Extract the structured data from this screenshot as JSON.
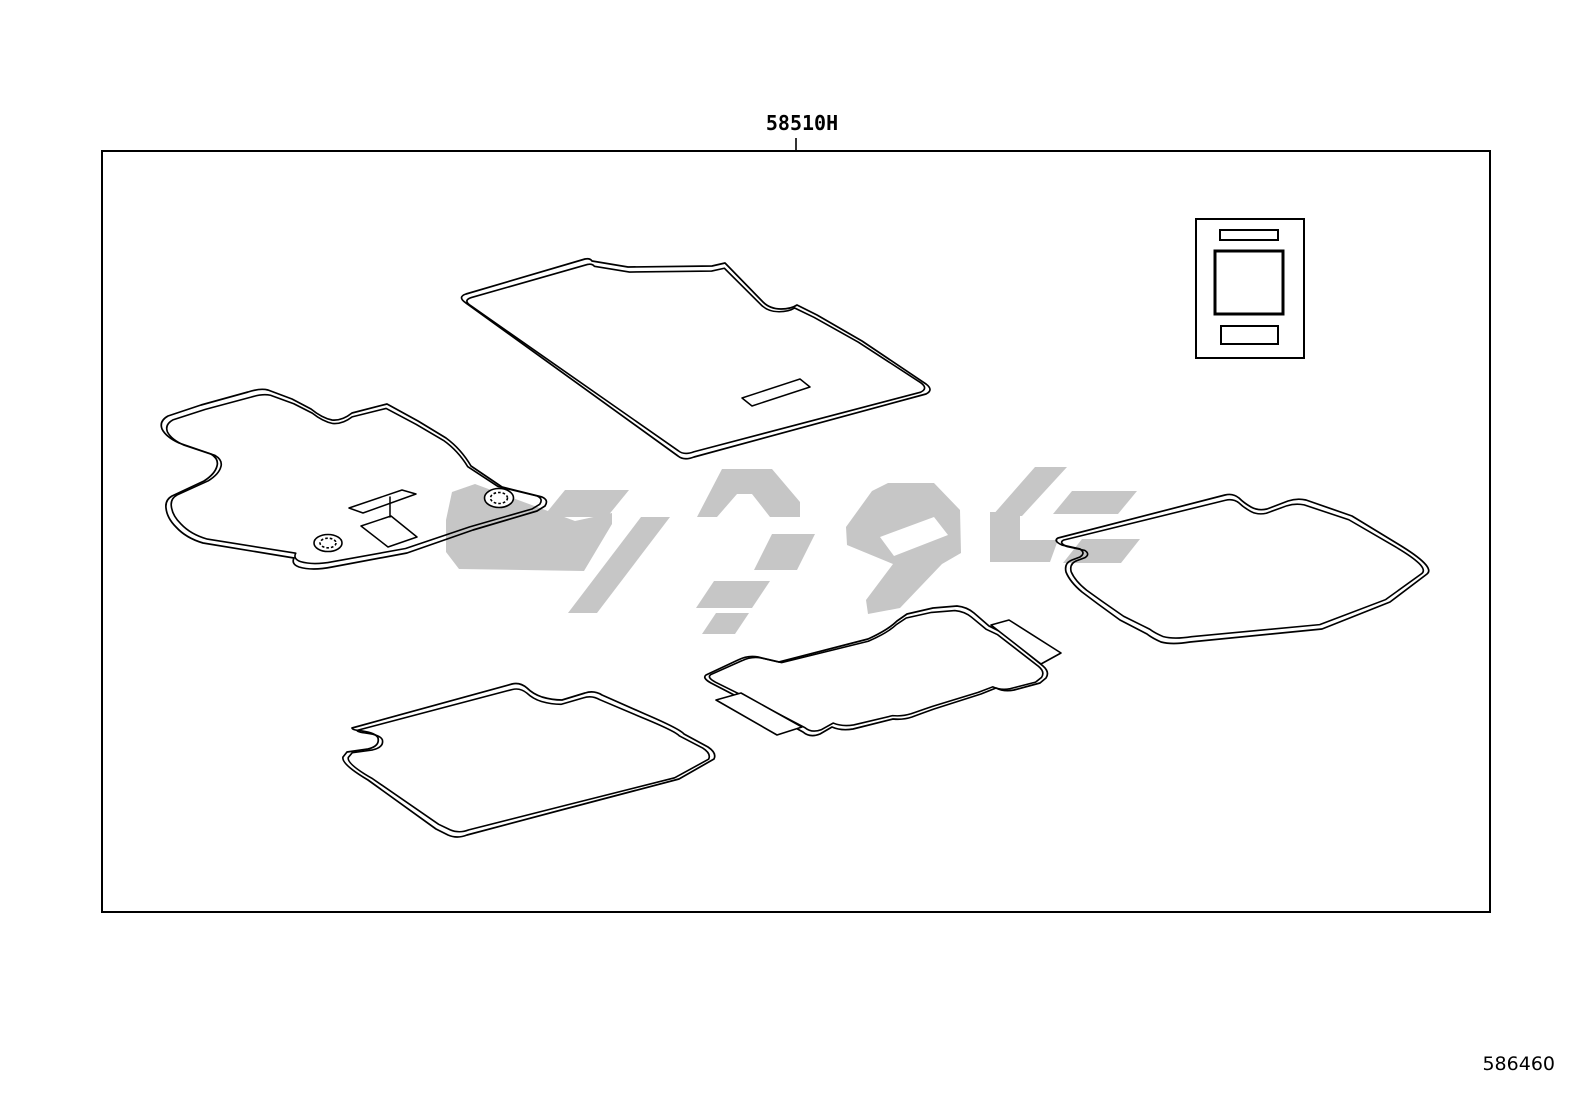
{
  "diagram": {
    "part_label": "58510H",
    "figure_code": "586460",
    "type": "parts-catalog-line-diagram",
    "subject": "floor mat set",
    "components": [
      {
        "name": "front-floor-mat"
      },
      {
        "name": "driver-floor-mat"
      },
      {
        "name": "rear-left-floor-mat"
      },
      {
        "name": "rear-center-floor-mat"
      },
      {
        "name": "rear-right-floor-mat"
      },
      {
        "name": "instruction-tag"
      }
    ],
    "watermark": "supplier-logo-watermark"
  },
  "colors": {
    "background": "#ffffff",
    "line": "#000000",
    "watermark": "#c6c6c6"
  }
}
